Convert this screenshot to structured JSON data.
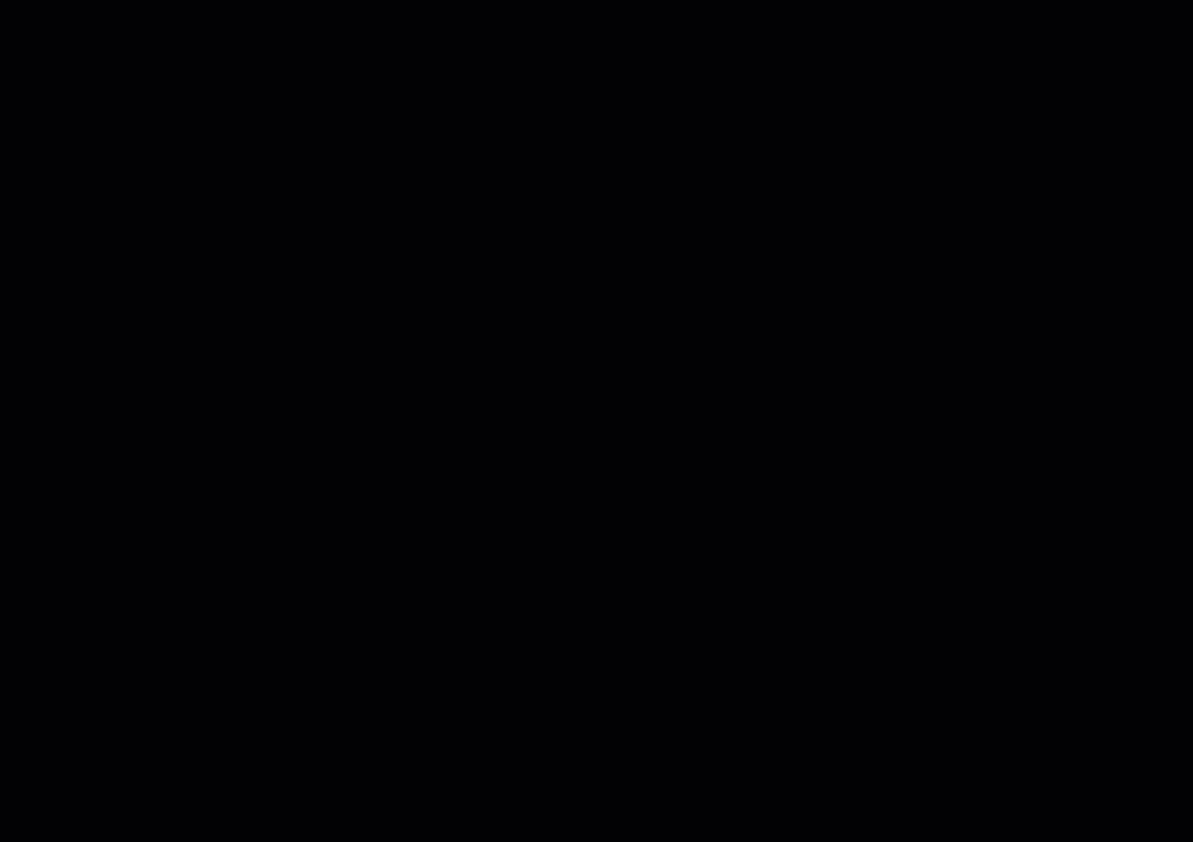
{
  "app": {
    "type": "pcb-cad-layout-view",
    "board_title": "NJB ARTWORK TOP",
    "board_number": "HSDC9-3028",
    "side": "TOP SIDE"
  },
  "palette": {
    "background": "#020204",
    "grid_dot": "#1d3a35",
    "grid_plus": "#2a4f47",
    "board_outline": "#d8dcc2",
    "construction_line": "#cfc9a0",
    "text_default": "#d9e4d8",
    "text_teal": "#60c0b0",
    "text_yellow": "#d8d840",
    "highlight_pink": "#e87fc0",
    "diode_yellow": "#e8e040",
    "pour_dark_red": "#580a14",
    "pour_purple": "#2a1040",
    "pour_cyan": "#177a86",
    "ladder_red": "#d02838",
    "trace_colors": [
      "#a81a30",
      "#7c1020",
      "#c430c8",
      "#8040d8",
      "#00a8c4",
      "#2b9a90",
      "#bcc944",
      "#d8d8cc",
      "#3c5cd0"
    ]
  },
  "title_block": {
    "col1": "VCA",
    "col2": "DESIGNER",
    "row_a": "A",
    "designer": "HUHONGMEI",
    "row_d": "D",
    "row_c": "C",
    "board_ref": "IBOARD"
  },
  "impedance_table": {
    "rows": [
      {
        "pair": "6 7",
        "ohms": "10"
      },
      {
        "pair": "6 7",
        "ohms": "90"
      },
      {
        "pair": "5 7",
        "ohms": "90"
      },
      {
        "pair": "5 7",
        "ohms": "90"
      },
      {
        "pair": "4 7",
        "ohms": "90"
      }
    ]
  },
  "stackup_left": [
    "VAF3-4",
    "SIGNAL",
    "4 Onl l",
    "G PLANE",
    "5 (ml",
    "SIGNAL",
    "VAF3"
  ],
  "layer_table": [
    "LAYER 1 (HOZ;PLATING)",
    "LAYER 3 (  1OZ  )",
    "(  1OZ  )",
    "LAYER 5  (",
    "LAYER 6 (HOZ PLATING)"
  ],
  "bottom_noise": "1A4H1 PAGE4HPGA 5HC1DO4H GAGPG5GD 5GA1GAGPA 3HGAGTH GCHA4DA1 H2CO8T HGA5D 4HPGA GD5GA 1GAGPA3 HGAGT HGCH A4DA1 H2CO8 THGA5D 4HPGA5 HC1DO4H GAGPG",
  "annotations": [
    {
      "t": "ACCORDING TO 6.10.2 OF",
      "x": 14,
      "y": 76
    },
    {
      "t": "CCORDING TO 6",
      "x": 0,
      "y": 121
    },
    {
      "t": "5MILS DIFFPAIR GAP 6.3098",
      "x": 2,
      "y": 156
    },
    {
      "t": "DANCE CAN BE",
      "x": 2,
      "y": 188
    },
    {
      "t": "SS CAN BE FREELY ADJUSTED",
      "x": 0,
      "y": 202
    },
    {
      "t": "TARGET IMPEDANCE",
      "x": 2,
      "y": 219
    },
    {
      "t": "E DRILL SHALL BE ACCORDING TO S",
      "x": 2,
      "y": 252
    },
    {
      "t": "'S LOGO(ID.) AND",
      "x": 2,
      "y": 286
    },
    {
      "t": "50 NILS DIAMETER",
      "x": 14,
      "y": 318
    },
    {
      "t": "59 NILS SPACING",
      "x": 14,
      "y": 334
    },
    {
      "t": "HAN 30 NILS SPEC",
      "x": 0,
      "y": 350
    },
    {
      "t": "ALU LAYERS FOR",
      "x": 0,
      "y": 366
    },
    {
      "t": "SOLDERMARK (EXCE",
      "x": 0,
      "y": 398
    },
    {
      "t": "PAD): ALL VIAS",
      "x": 0,
      "y": 414
    },
    {
      "t": "TOP SIDE",
      "x": 508,
      "y": 10,
      "s": 9
    },
    {
      "t": "PREPREG",
      "x": 512,
      "y": 32,
      "s": 9
    },
    {
      "t": "CORE",
      "x": 487,
      "y": 97,
      "s": 7
    },
    {
      "t": "VAF3-4",
      "x": 378,
      "y": 15,
      "s": 7.5
    },
    {
      "t": "SIGNAL",
      "x": 416,
      "y": 20,
      "s": 7.5
    },
    {
      "t": "4 Onl l",
      "x": 410,
      "y": 33,
      "s": 7
    },
    {
      "t": "G PLANE",
      "x": 412,
      "y": 45,
      "s": 7.5
    },
    {
      "t": "5 (ml",
      "x": 406,
      "y": 57,
      "s": 7
    },
    {
      "t": "SIGNAL",
      "x": 408,
      "y": 68,
      "s": 7.5
    },
    {
      "t": "VAF3",
      "x": 470,
      "y": 15,
      "s": 7.5
    },
    {
      "t": "LAYER 1 (HOZ;PLATING)",
      "x": 634,
      "y": 20,
      "s": 9,
      "ls": 1
    },
    {
      "t": "NJB ARTWORK TOP",
      "x": 812,
      "y": 17,
      "s": 9,
      "ls": 1
    },
    {
      "t": "HSDC9-3028",
      "x": 908,
      "y": 21,
      "s": 8.5
    },
    {
      "t": "GROUND PLANE02",
      "x": 832,
      "y": 45,
      "s": 8.5,
      "ls": 1
    },
    {
      "t": "ARTWORK LAYER03",
      "x": 836,
      "y": 70,
      "s": 8.5,
      "ls": 1
    },
    {
      "t": "NETWORK LAYER04",
      "x": 836,
      "y": 94,
      "s": 8.5,
      "ls": 1
    },
    {
      "t": "BOTTON",
      "x": 876,
      "y": 138,
      "s": 8.5,
      "ls": 1
    },
    {
      "t": "LAYER 3 (  1OZ  )",
      "x": 638,
      "y": 40,
      "s": 8
    },
    {
      "t": "(  1OZ  )",
      "x": 712,
      "y": 66,
      "s": 8
    },
    {
      "t": "1OZ",
      "x": 722,
      "y": 88,
      "s": 8
    },
    {
      "t": "LAYER 5  (",
      "x": 633,
      "y": 116,
      "s": 8
    },
    {
      "t": "205 255",
      "x": 756,
      "y": 113,
      "s": 7
    },
    {
      "t": "W3 68",
      "x": 800,
      "y": 122,
      "s": 7
    },
    {
      "t": "LAYER 6 (HOZ PLATING)",
      "x": 633,
      "y": 139,
      "s": 8
    },
    {
      "t": "VCA",
      "x": 1085,
      "y": 14,
      "s": 8.5
    },
    {
      "t": "DESIGNER",
      "x": 1126,
      "y": 14,
      "s": 8.5
    },
    {
      "t": "A",
      "x": 1091,
      "y": 38,
      "s": 8
    },
    {
      "t": "HUHONGMEI",
      "x": 1120,
      "y": 38,
      "s": 8.5
    },
    {
      "t": "IBOARD",
      "x": 1048,
      "y": 54,
      "s": 7.5
    },
    {
      "t": "1SW1 PW",
      "x": 1093,
      "y": 92,
      "s": 7,
      "r": 180
    },
    {
      "t": "D",
      "x": 1089,
      "y": 99,
      "s": 8
    },
    {
      "t": "C",
      "x": 1090,
      "y": 122,
      "s": 8
    },
    {
      "t": "S I N G L E   [ M",
      "x": 1055,
      "y": 175,
      "s": 11
    },
    {
      "t": "PINCO101",
      "x": 1110,
      "y": 204,
      "s": 7.5
    },
    {
      "t": "PLATED OVAL",
      "x": 1142,
      "y": 206,
      "s": 7,
      "c": "#d8d840"
    },
    {
      "t": "PLATED O",
      "x": 1158,
      "y": 234,
      "s": 7,
      "c": "#d8d840"
    },
    {
      "t": "PLATED O",
      "x": 1156,
      "y": 258,
      "s": 7,
      "c": "#d8d840"
    },
    {
      "t": "50",
      "x": 1184,
      "y": 196,
      "s": 8
    },
    {
      "t": "50",
      "x": 1184,
      "y": 224,
      "s": 8
    },
    {
      "t": "I  S",
      "x": 1146,
      "y": 282,
      "s": 13
    },
    {
      "t": "E R E N T I A L",
      "x": 1036,
      "y": 303,
      "s": 14
    },
    {
      "t": "[M",
      "x": 1176,
      "y": 324,
      "s": 8
    },
    {
      "t": "6 7",
      "x": 1098,
      "y": 352,
      "s": 8
    },
    {
      "t": "10",
      "x": 1179,
      "y": 352,
      "s": 8
    },
    {
      "t": "6 7",
      "x": 1098,
      "y": 367,
      "s": 8
    },
    {
      "t": "90",
      "x": 1179,
      "y": 367,
      "s": 8
    },
    {
      "t": "5 7",
      "x": 1098,
      "y": 382,
      "s": 8
    },
    {
      "t": "90",
      "x": 1179,
      "y": 382,
      "s": 8
    },
    {
      "t": "5 7",
      "x": 1098,
      "y": 397,
      "s": 8
    },
    {
      "t": "90",
      "x": 1179,
      "y": 397,
      "s": 8
    },
    {
      "t": "4 7",
      "x": 1096,
      "y": 413,
      "s": 8
    },
    {
      "t": "90",
      "x": 1179,
      "y": 413,
      "s": 8
    },
    {
      "t": "OC1230",
      "x": 972,
      "y": 398,
      "s": 7,
      "c": "#60c0b0"
    },
    {
      "t": "STC3216",
      "x": 960,
      "y": 416,
      "s": 8,
      "c": "#60c0b0"
    },
    {
      "t": "AO8O3",
      "x": 868,
      "y": 440,
      "s": 7,
      "c": "#60c0b0"
    },
    {
      "t": "5AO8O3",
      "x": 930,
      "y": 505,
      "s": 7,
      "c": "#60c0b0"
    },
    {
      "t": "H2CO8TO5@AO8O5",
      "x": 1051,
      "y": 520,
      "s": 6.5,
      "c": "#60c0b0",
      "r": 90
    },
    {
      "t": "SC0603",
      "x": 270,
      "y": 218,
      "s": 6.5,
      "c": "#60c0b0"
    },
    {
      "t": "C0603",
      "x": 700,
      "y": 253,
      "s": 6.5,
      "c": "#60c0b0"
    },
    {
      "t": "R0603",
      "x": 760,
      "y": 98,
      "s": 6.5,
      "c": "#60c0b0"
    },
    {
      "t": "E0803",
      "x": 76,
      "y": 289,
      "s": 6.5
    },
    {
      "t": "HOLE125 8ST +",
      "x": 78,
      "y": 300,
      "s": 6.5
    },
    {
      "t": "HOLC45-180C",
      "x": 136,
      "y": 175,
      "s": 6.5
    },
    {
      "t": "J5 LEVEL  B B",
      "x": 460,
      "y": 330,
      "s": 11,
      "ls": 3
    },
    {
      "t": "SIP TP",
      "x": 452,
      "y": 166,
      "s": 7.5
    },
    {
      "t": "SIP SP",
      "x": 660,
      "y": 326,
      "s": 7.5,
      "r": 180
    },
    {
      "t": "MSI BSS",
      "x": 308,
      "y": 632,
      "s": 7
    },
    {
      "t": "SSW PUSH",
      "x": 345,
      "y": 662,
      "s": 7,
      "r": 180
    },
    {
      "t": "2060A2",
      "x": 225,
      "y": 692,
      "s": 7,
      "c": "#60c0b0",
      "r": 180
    },
    {
      "t": "503 65-10 250 5W15 20 350",
      "x": 385,
      "y": 720,
      "s": 7
    },
    {
      "t": "SC0802",
      "x": 310,
      "y": 731,
      "s": 7.5,
      "r": 180
    },
    {
      "t": "SC0802",
      "x": 372,
      "y": 731,
      "s": 7.5,
      "r": 180
    },
    {
      "t": "SC0802",
      "x": 478,
      "y": 731,
      "s": 7.5,
      "r": 180
    },
    {
      "t": "SC0802",
      "x": 850,
      "y": 731,
      "s": 7.5,
      "r": 180
    },
    {
      "t": "SC0802",
      "x": 945,
      "y": 731,
      "s": 7.5,
      "r": 180
    },
    {
      "t": "SATA7-M",
      "x": 690,
      "y": 719,
      "s": 7,
      "r": 180
    },
    {
      "t": "BD0603 03",
      "x": 765,
      "y": 699,
      "s": 7,
      "r": 180
    },
    {
      "t": "HOLE125.85T/AR",
      "x": 1118,
      "y": 718,
      "s": 7.5
    },
    {
      "t": "04A0&W3TEC.TD",
      "x": 1060,
      "y": 724,
      "s": 7,
      "r": 180
    },
    {
      "t": "2",
      "x": 610,
      "y": 817,
      "s": 7,
      "c": "#d8d840"
    }
  ]
}
